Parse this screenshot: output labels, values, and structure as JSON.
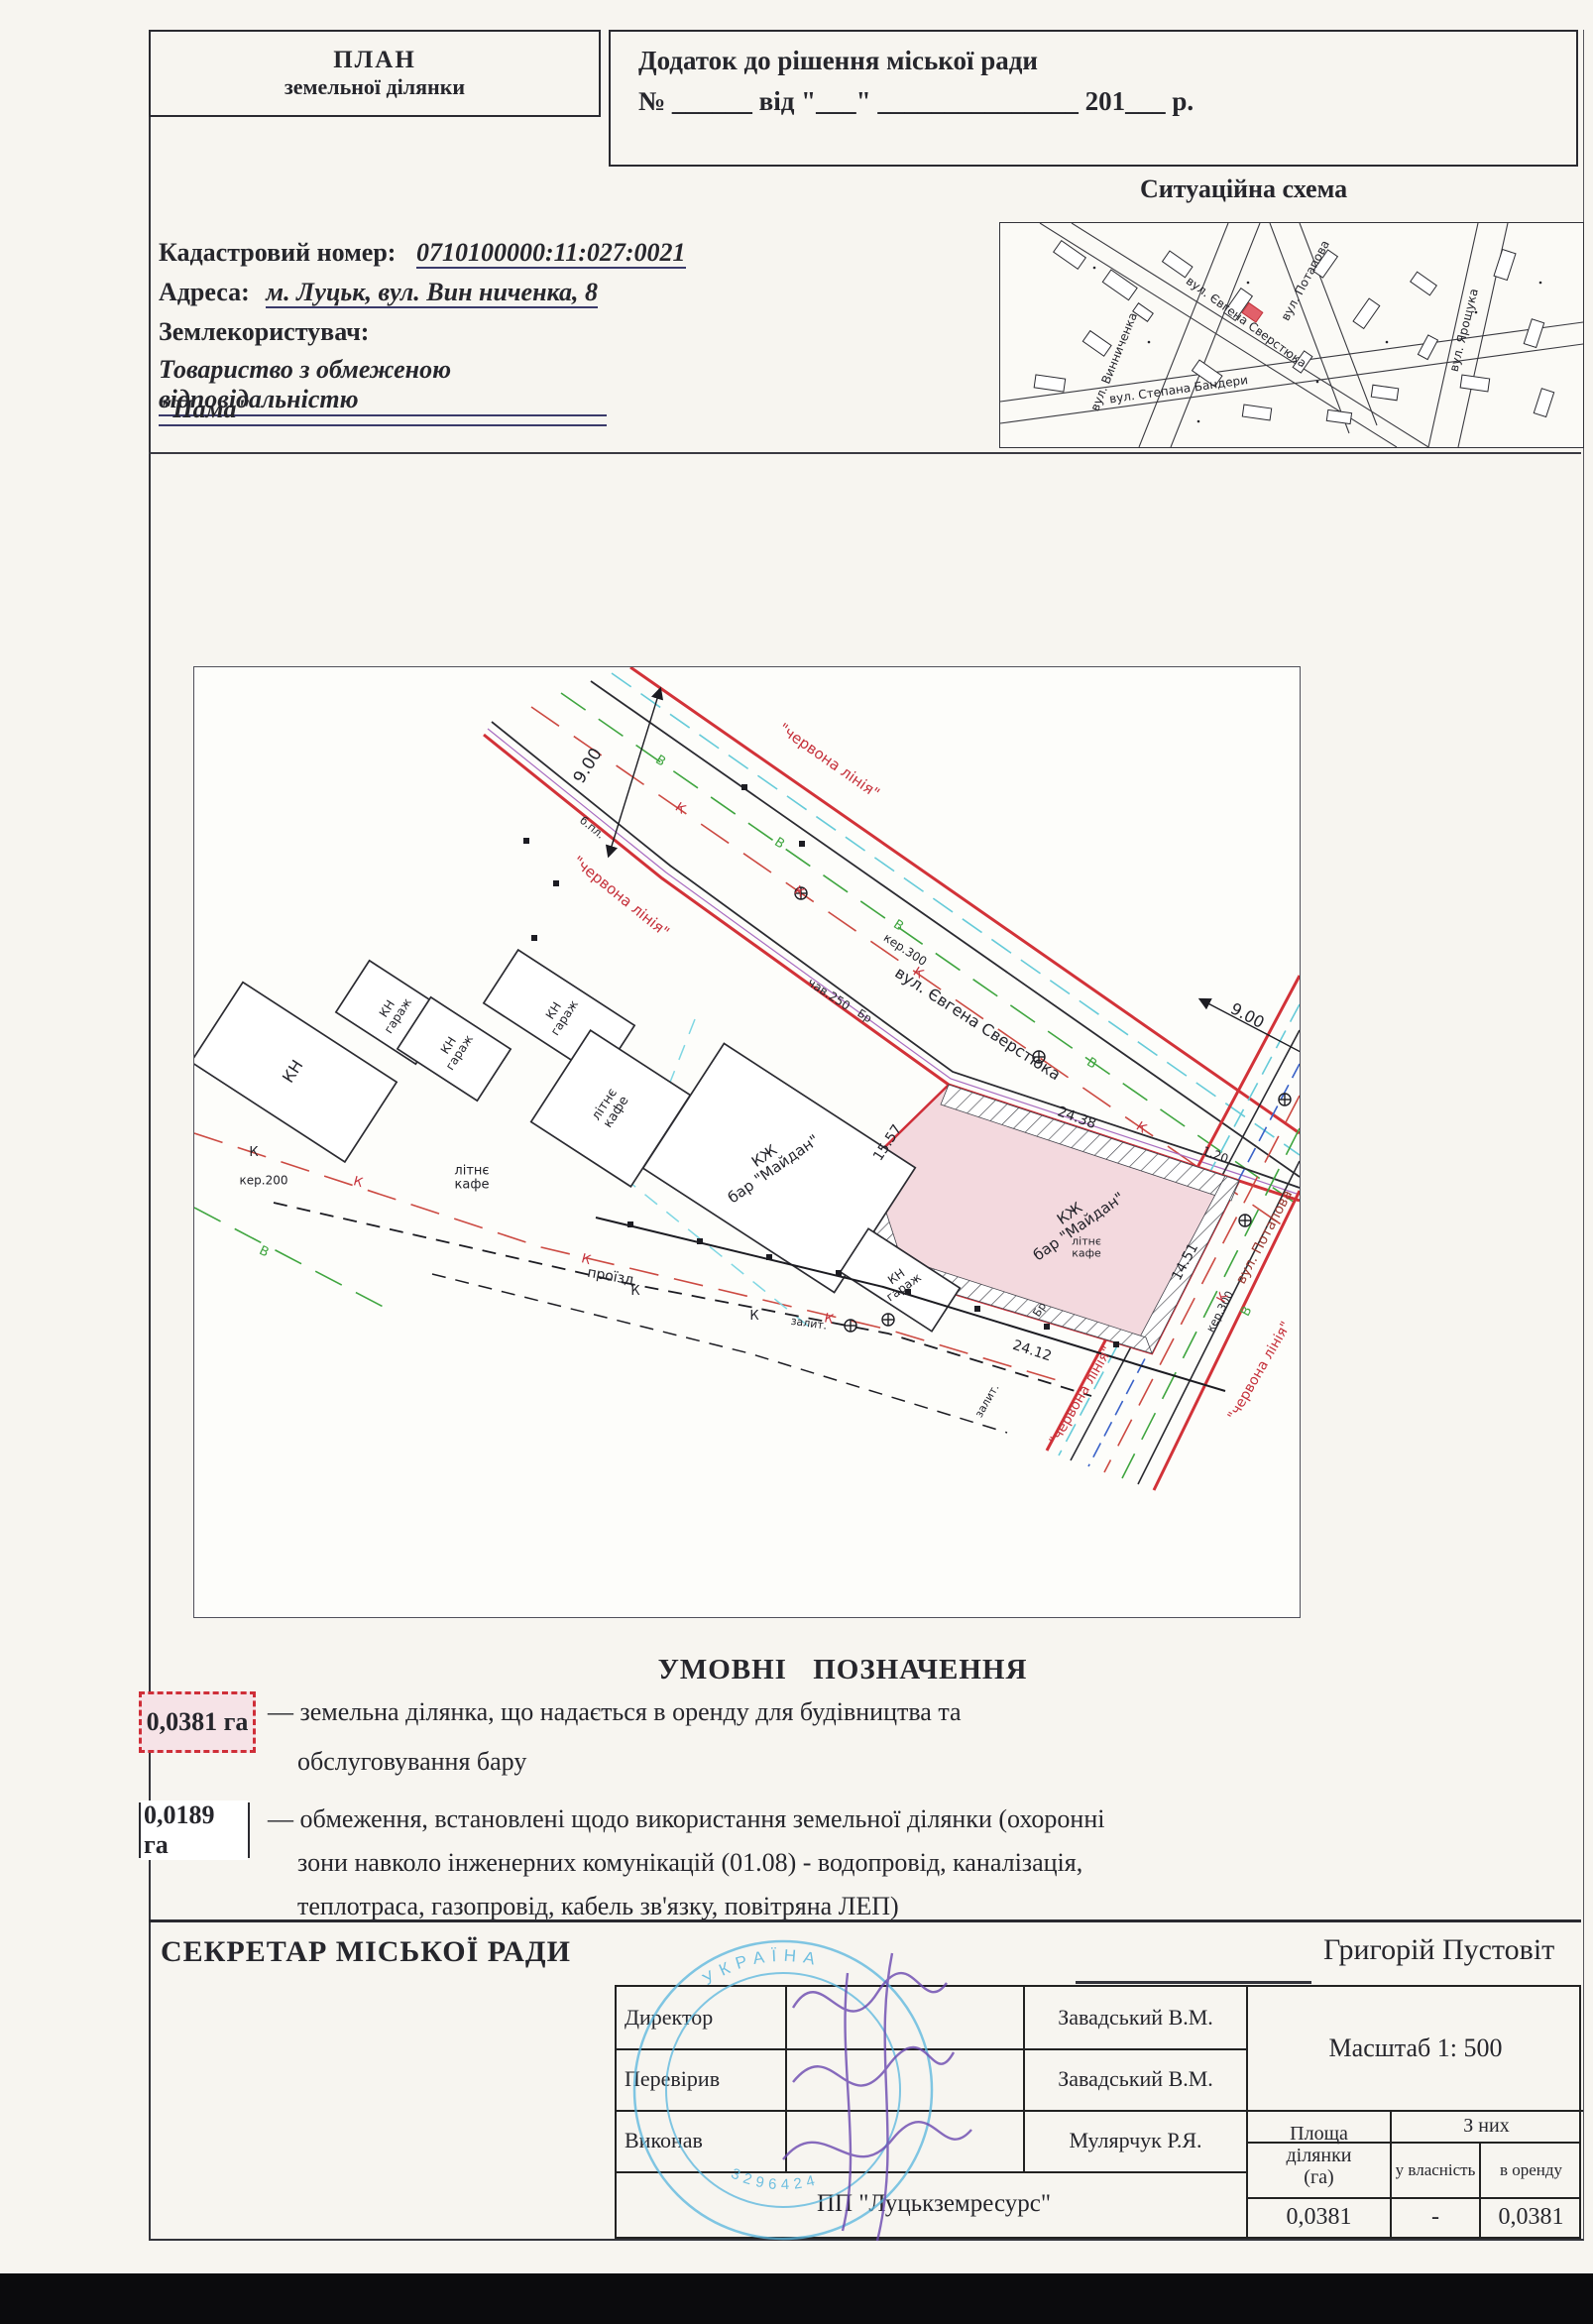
{
  "header": {
    "plan_title_line1": "ПЛАН",
    "plan_title_line2": "земельної ділянки",
    "decision_title": "Додаток до рішення  міської ради",
    "decision_blank_line": "№ ______ від \"___\" _______________ 201___ р."
  },
  "situation_scheme": {
    "title": "Ситуаційна схема",
    "street_vynnychenka": "вул. Винниченка",
    "street_sverstiuka": "вул. Євгена Сверстюка",
    "street_potapova": "вул. Потапова",
    "street_yaroshchuka": "вул. Ярощука",
    "street_bandery": "вул. Степана Бандери"
  },
  "cadastral": {
    "number_label": "Кадастровий номер:",
    "number_value": "0710100000:11:027:0021",
    "address_label": "Адреса:",
    "address_value": "м. Луцьк, вул. Вин ниченка, 8",
    "user_label": "Землекористувач:",
    "user_value_line1": "Товариство з обмеженою відповідальністю",
    "user_value_line2": "\"Пама\""
  },
  "plan": {
    "red_line_label": "\"червона лінія\"",
    "street_sverstiuka": "вул. Євгена Сверстюка",
    "street_potapova": "вул. Потапова",
    "dim_width_9": "9.00",
    "dim_15_57": "15.57",
    "dim_24_38": "24.38",
    "dim_24_12": "24.12",
    "dim_14_51": "14.51",
    "dim_1_20": "1.20",
    "pipe_ker300": "кер.300",
    "pipe_ker200": "кер.200",
    "pipe_chav250": "чав.250",
    "pipe_br": "Бр",
    "pipe_bpl": "б.пл.",
    "marker_k": "К",
    "marker_v": "В",
    "bld_kn": "КН",
    "bld_garage": "гараж",
    "bld_kzh": "КЖ",
    "bld_bar": "бар \"Майдан\"",
    "litne_kafe_1": "літнє",
    "litne_kafe_2": "кафе",
    "proizd": "проїзд",
    "zalit": "залит."
  },
  "legend": {
    "title": "УМОВНІ ПОЗНАЧЕННЯ",
    "item1_value": "0,0381 га",
    "item1_text_line1": "— земельна ділянка, що надається в оренду для будівництва та",
    "item1_text_line2": "обслуговування бару",
    "item2_value": "0,0189 га",
    "item2_text_line1": "— обмеження, встановлені щодо використання земельної ділянки (охоронні",
    "item2_text_line2": "зони навколо інженерних комунікацій (01.08) - водопровід, каналізація,",
    "item2_text_line3": "теплотраса, газопровід, кабель зв'язку, повітряна ЛЕП)"
  },
  "footer": {
    "secretary_label": "СЕКРЕТАР МІСЬКОЇ РАДИ",
    "secretary_name": "Григорій Пустовіт",
    "row_director_label": "Директор",
    "row_director_name": "Завадський В.М.",
    "row_checked_label": "Перевірив",
    "row_checked_name": "Завадський В.М.",
    "row_executed_label": "Виконав",
    "row_executed_name": "Мулярчук Р.Я.",
    "scale_label": "Масштаб  1: 500",
    "company": "ПП \"Луцькземресурс\"",
    "area_header_line1": "Площа",
    "area_header_line2": "ділянки",
    "area_header_line3": "(га)",
    "of_them": "З них",
    "col_ownership": "у власність",
    "col_lease": "в оренду",
    "val_area": "0,0381",
    "val_ownership": "-",
    "val_lease": "0,0381",
    "stamp_country": "УКРАЇНА",
    "stamp_number": "3296424"
  },
  "colors": {
    "red_line": "#d23238",
    "water_green": "#3fa53f",
    "sewer_red": "#cc4a42",
    "comm_cyan": "#66cbd9",
    "plot_pink": "#f3d9de",
    "stamp_blue": "#58b6de",
    "signature_purple": "#6b48b0"
  }
}
